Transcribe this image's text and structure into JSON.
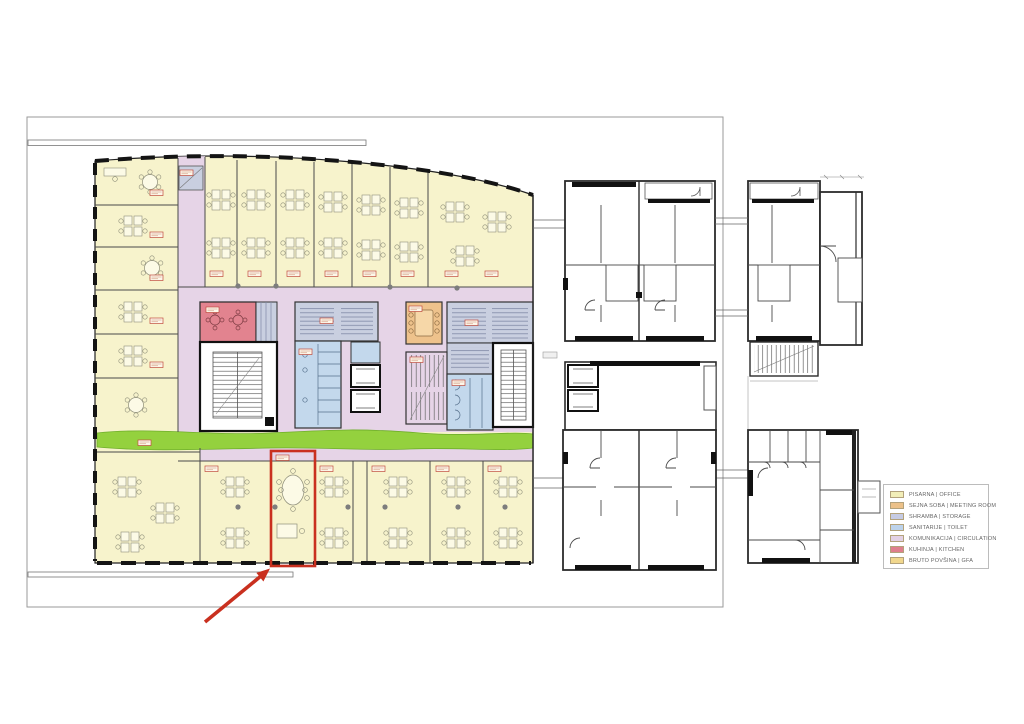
{
  "legend": {
    "items": [
      {
        "label": "PISARNA | OFFICE",
        "color": "#f2eeb8"
      },
      {
        "label": "SEJNA SOBA | MEETING ROOM",
        "color": "#ecc189"
      },
      {
        "label": "SHRAMBA | STORAGE",
        "color": "#c6cbe3"
      },
      {
        "label": "SANITARIJE | TOILET",
        "color": "#bdd3eb"
      },
      {
        "label": "KOMUNIKACIJA | CIRCULATION",
        "color": "#e3d1e5"
      },
      {
        "label": "KUHINJA | KITCHEN",
        "color": "#df7f8d"
      },
      {
        "label": "BRUTO POVŠINA | GFA",
        "color": "#f1d78d"
      }
    ]
  },
  "plan_colors": {
    "office": "#f7f3cc",
    "meeting": "#eec28c",
    "storage": "#c9cfe0",
    "toilet": "#c3d8ec",
    "circulation": "#e6d4e7",
    "kitchen": "#e2838f",
    "gfa": "#f2d88e",
    "greenery": "#94d13e",
    "highlight": "#c9301f",
    "wall": "#1a1a1a"
  }
}
